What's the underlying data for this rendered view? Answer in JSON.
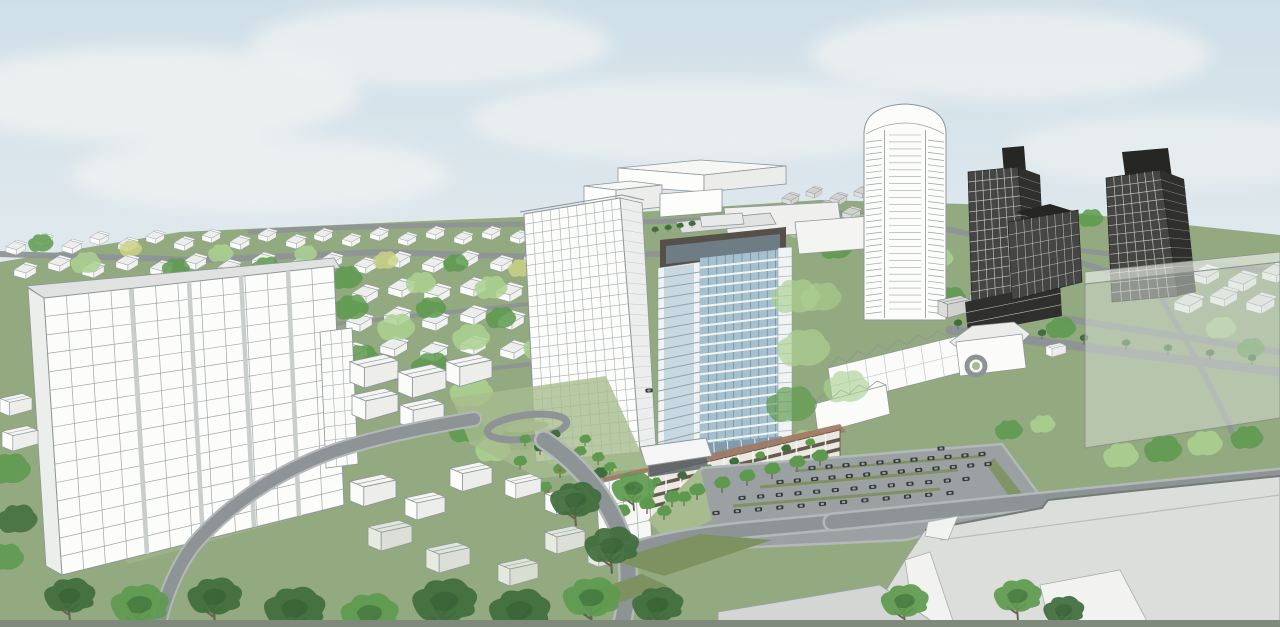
{
  "meta": {
    "title": "Aerial 3D architectural massing rendering of a proposed residential high-rise development",
    "type": "3d-architectural-rendering",
    "view": "aerial-oblique"
  },
  "scene": {
    "sky": {
      "label": "pale blue sky with soft white clouds"
    },
    "background": {
      "label": "low-rise neighbourhood of small white gabled houses among green trees"
    },
    "buildings": [
      {
        "name": "existing-slab-tower",
        "desc": "large white gridded slab tower, about 18 storeys, flat grey roof band, left foreground"
      },
      {
        "name": "white-midrise-tower",
        "desc": "white point tower with fine window grid, about 24 storeys, centre-left"
      },
      {
        "name": "proposed-blue-tower",
        "desc": "blue-glass tower with white balcony bands and dark crown, about 22 storeys, centre"
      },
      {
        "name": "podium",
        "desc": "4-storey podium with cream walls, dark window bands, rooftop terrace planted with small trees"
      },
      {
        "name": "rounded-top-tower",
        "desc": "white tower with rounded cap and balcony ladders, about 30 storeys, right of centre"
      },
      {
        "name": "dark-tower-east",
        "desc": "dark gridded tower with rooftop box, about 20 storeys"
      },
      {
        "name": "dark-midrise",
        "desc": "dark terraced mid-rise slab between the two dark towers"
      },
      {
        "name": "dark-tower-far-east",
        "desc": "second dark gridded tower with rooftop box, about 20 storeys"
      },
      {
        "name": "ghost-massing-box",
        "desc": "large semi-transparent massing box at right edge"
      },
      {
        "name": "big-box-roof",
        "desc": "large flat grey commercial roofs, bottom right"
      },
      {
        "name": "townhouse-rows",
        "desc": "two rows of white gabled townhouses with hip-roof apartment block, centre-right"
      },
      {
        "name": "commercial-boxes",
        "desc": "plain white flat-roofed commercial blocks behind the towers"
      },
      {
        "name": "ghosted-houses",
        "desc": "cluster of translucent white house blocks in the foreground lawn"
      }
    ],
    "landscape": [
      {
        "name": "surface-parking-lot",
        "desc": "grey parking lot with rows of dark cars and olive planting islands"
      },
      {
        "name": "drop-off-loop",
        "desc": "small oval drop-off loop with landscaped island, left of the podium"
      },
      {
        "name": "parkette",
        "desc": "small garden of round trees and flower beds beside the podium"
      },
      {
        "name": "roads",
        "desc": "curving grey streets with olive median islands converging at bottom centre"
      },
      {
        "name": "tree-belt",
        "desc": "band of dark sketchy deciduous trees across the foreground"
      }
    ],
    "counts": {
      "parked-cars-approx": 57,
      "road-cars": 3,
      "towers": 6,
      "townhouse-rows": 2
    }
  },
  "palette": {
    "sky_top": "#cfdfe8",
    "sky_bottom": "#e2eaee",
    "cloud": "#edf1f1",
    "grass": "#93aa80",
    "grass_light": "#a7bb8e",
    "grass_olive": "#7e9160",
    "road": "#8e9496",
    "road_light": "#b3b8b9",
    "bldg_white": "#fbfbfa",
    "bldg_shade": "#e8eae9",
    "bldg_line": "#8d9598",
    "roof_band": "#e0e2e1",
    "glass_blue": "#a5c1cf",
    "glass_deep": "#7e9aaa",
    "balcony": "#f0f3f3",
    "crown": "#56504a",
    "podium_wall": "#ebe8e1",
    "podium_band": "#5d5347",
    "terrace": "#a17a64",
    "dark_tower": "#454543",
    "dark_side": "#2f2f2d",
    "ghost": "#d6ded4",
    "bigbox": "#dcdedc",
    "bigbox_white": "#f2f2f0",
    "tree_dark": "#3f6d3c",
    "tree_mid": "#5d9a4e",
    "tree_light": "#abd190",
    "tree_yellow": "#cbd286",
    "trunk": "#6c645c",
    "car": "#34383b",
    "flower_red": "#c0563f",
    "flower_yellow": "#d9c14e",
    "bottom_strip": "#7f8a7d"
  }
}
